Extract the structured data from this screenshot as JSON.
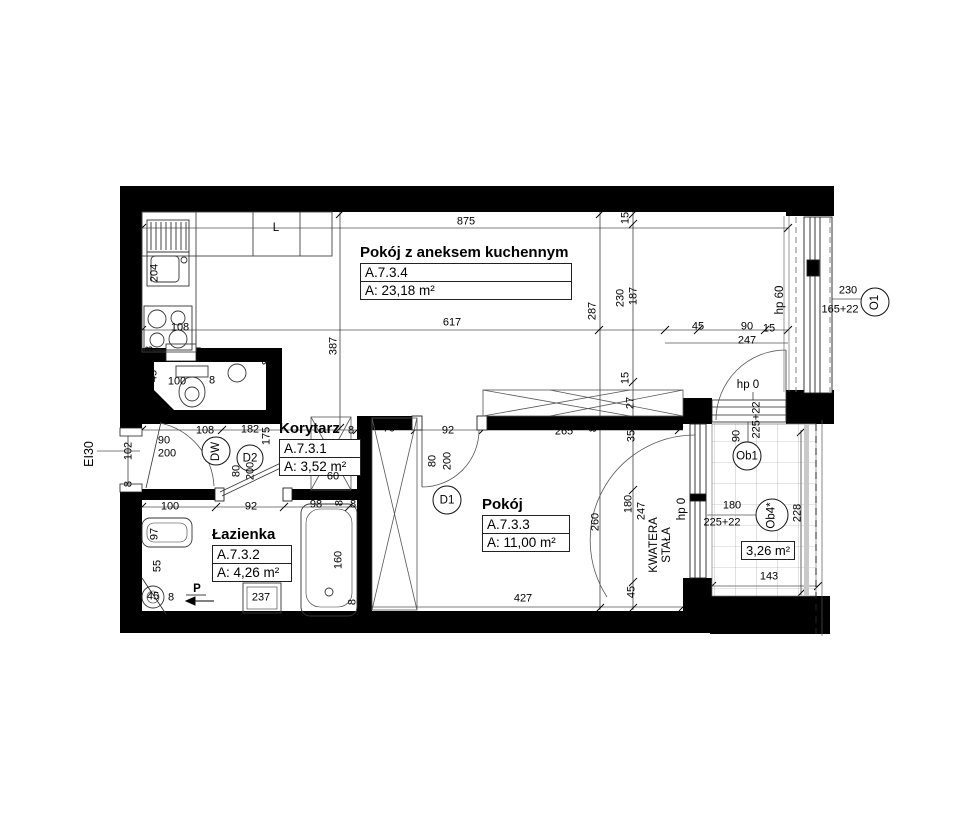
{
  "rooms": [
    {
      "name": "Pokój z aneksem kuchennym",
      "code": "A.7.3.4",
      "area": "A: 23,18 m²"
    },
    {
      "name": "Korytarz",
      "code": "A.7.3.1",
      "area": "A: 3,52 m²"
    },
    {
      "name": "Łazienka",
      "code": "A.7.3.2",
      "area": "A: 4,26 m²"
    },
    {
      "name": "Pokój",
      "code": "A.7.3.3",
      "area": "A: 11,00 m²"
    },
    {
      "name": "Balkon",
      "area": "3,26 m²"
    }
  ],
  "bubbles": {
    "dw": "DW",
    "d2": "D2",
    "d1": "D1",
    "o1": "O1",
    "ob1": "Ob1",
    "ob4": "Ob4*"
  },
  "annotations": {
    "fire_rating": "EI30",
    "fridge": "L",
    "shaft": "P",
    "fixed_panel_line1": "KWATERA",
    "fixed_panel_line2": "STAŁA",
    "hp0_kitchen": "hp 0",
    "hp0_room": "hp 0",
    "hp60": "hp 60",
    "o1_width": "230",
    "o1_height": "165+22"
  },
  "dim_labels": [
    {
      "t": "875",
      "x": 466,
      "y": 222,
      "v": false
    },
    {
      "t": "617",
      "x": 452,
      "y": 323,
      "v": false
    },
    {
      "t": "287",
      "x": 593,
      "y": 311,
      "v": true
    },
    {
      "t": "230",
      "x": 621,
      "y": 298,
      "v": true
    },
    {
      "t": "187",
      "x": 634,
      "y": 296,
      "v": true
    },
    {
      "t": "15",
      "x": 626,
      "y": 218,
      "v": true
    },
    {
      "t": "15",
      "x": 626,
      "y": 378,
      "v": true
    },
    {
      "t": "387",
      "x": 334,
      "y": 346,
      "v": true
    },
    {
      "t": "8",
      "x": 267,
      "y": 362,
      "v": true
    },
    {
      "t": "204",
      "x": 155,
      "y": 273,
      "v": true
    },
    {
      "t": "8",
      "x": 150,
      "y": 349,
      "v": true
    },
    {
      "t": "108",
      "x": 180,
      "y": 328,
      "v": false
    },
    {
      "t": "45",
      "x": 698,
      "y": 327,
      "v": false
    },
    {
      "t": "90",
      "x": 747,
      "y": 327,
      "v": false
    },
    {
      "t": "15",
      "x": 769,
      "y": 329,
      "v": false
    },
    {
      "t": "247",
      "x": 747,
      "y": 341,
      "v": false
    },
    {
      "t": "230",
      "x": 848,
      "y": 291,
      "v": false
    },
    {
      "t": "165+22",
      "x": 840,
      "y": 310,
      "v": false
    },
    {
      "t": "225+22",
      "x": 757,
      "y": 420,
      "v": true
    },
    {
      "t": "90",
      "x": 737,
      "y": 436,
      "v": true
    },
    {
      "t": "12",
      "x": 129,
      "y": 416,
      "v": true
    },
    {
      "t": "102",
      "x": 129,
      "y": 451,
      "v": true
    },
    {
      "t": "8",
      "x": 129,
      "y": 484,
      "v": true
    },
    {
      "t": "90",
      "x": 164,
      "y": 441,
      "v": false
    },
    {
      "t": "200",
      "x": 167,
      "y": 454,
      "v": false
    },
    {
      "t": "80",
      "x": 237,
      "y": 471,
      "v": true
    },
    {
      "t": "200",
      "x": 251,
      "y": 471,
      "v": true
    },
    {
      "t": "45",
      "x": 154,
      "y": 376,
      "v": true
    },
    {
      "t": "100",
      "x": 177,
      "y": 382,
      "v": false
    },
    {
      "t": "8",
      "x": 212,
      "y": 381,
      "v": false
    },
    {
      "t": "8",
      "x": 149,
      "y": 401,
      "v": true
    },
    {
      "t": "108",
      "x": 205,
      "y": 431,
      "v": false
    },
    {
      "t": "182",
      "x": 250,
      "y": 430,
      "v": false
    },
    {
      "t": "175",
      "x": 267,
      "y": 436,
      "v": true
    },
    {
      "t": "8",
      "x": 351,
      "y": 431,
      "v": false
    },
    {
      "t": "70",
      "x": 389,
      "y": 429,
      "v": false
    },
    {
      "t": "92",
      "x": 448,
      "y": 431,
      "v": false
    },
    {
      "t": "80",
      "x": 433,
      "y": 461,
      "v": true
    },
    {
      "t": "200",
      "x": 448,
      "y": 461,
      "v": true
    },
    {
      "t": "265",
      "x": 564,
      "y": 432,
      "v": false
    },
    {
      "t": "8",
      "x": 594,
      "y": 429,
      "v": true
    },
    {
      "t": "60",
      "x": 333,
      "y": 477,
      "v": false
    },
    {
      "t": "27",
      "x": 631,
      "y": 403,
      "v": true
    },
    {
      "t": "35",
      "x": 632,
      "y": 436,
      "v": true
    },
    {
      "t": "180",
      "x": 629,
      "y": 504,
      "v": true
    },
    {
      "t": "247",
      "x": 642,
      "y": 511,
      "v": true
    },
    {
      "t": "45",
      "x": 632,
      "y": 592,
      "v": true
    },
    {
      "t": "260",
      "x": 596,
      "y": 522,
      "v": true
    },
    {
      "t": "427",
      "x": 523,
      "y": 599,
      "v": false
    },
    {
      "t": "100",
      "x": 170,
      "y": 507,
      "v": false
    },
    {
      "t": "92",
      "x": 251,
      "y": 507,
      "v": false
    },
    {
      "t": "98",
      "x": 316,
      "y": 505,
      "v": false
    },
    {
      "t": "8",
      "x": 340,
      "y": 503,
      "v": true
    },
    {
      "t": "8",
      "x": 353,
      "y": 505,
      "v": false
    },
    {
      "t": "97",
      "x": 155,
      "y": 534,
      "v": true
    },
    {
      "t": "160",
      "x": 339,
      "y": 560,
      "v": true
    },
    {
      "t": "237",
      "x": 261,
      "y": 598,
      "v": false
    },
    {
      "t": "55",
      "x": 158,
      "y": 566,
      "v": true
    },
    {
      "t": "45",
      "x": 153,
      "y": 597,
      "v": false
    },
    {
      "t": "8",
      "x": 171,
      "y": 598,
      "v": false
    },
    {
      "t": "8",
      "x": 353,
      "y": 602,
      "v": true
    },
    {
      "t": "180",
      "x": 732,
      "y": 506,
      "v": false
    },
    {
      "t": "225+22",
      "x": 722,
      "y": 523,
      "v": false
    },
    {
      "t": "228",
      "x": 798,
      "y": 513,
      "v": true
    },
    {
      "t": "143",
      "x": 769,
      "y": 577,
      "v": false
    }
  ]
}
